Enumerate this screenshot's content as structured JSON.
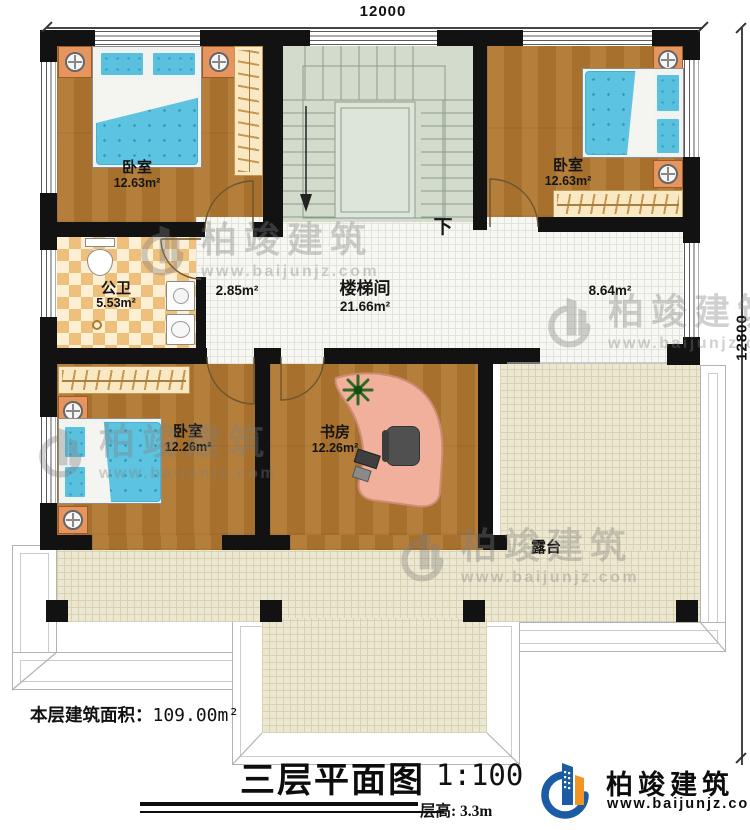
{
  "dimensions": {
    "width_mm": "12000",
    "height_mm": "12800"
  },
  "rooms": {
    "bedroom_tl": {
      "name": "卧室",
      "area": "12.63m²"
    },
    "bedroom_tr": {
      "name": "卧室",
      "area": "12.63m²"
    },
    "bathroom": {
      "name": "公卫",
      "area": "5.53m²"
    },
    "stairwell": {
      "name": "楼梯间",
      "area": "21.66m²"
    },
    "hall_left": {
      "area": "2.85m²"
    },
    "hall_right": {
      "area": "8.64m²"
    },
    "bedroom_bl": {
      "name": "卧室",
      "area": "12.26m²"
    },
    "study": {
      "name": "书房",
      "area": "12.26m²"
    },
    "terrace": {
      "name": "露台"
    },
    "stairs_down_label": "下"
  },
  "footer": {
    "floor_area_label": "本层建筑面积：",
    "floor_area_value": "109.00m²",
    "title": "三层平面图",
    "scale": "1:100",
    "floor_height": "层高: 3.3m"
  },
  "branding": {
    "company": "柏竣建筑",
    "website": "www.baijunjz.com"
  },
  "watermark": {
    "company": "柏竣建筑",
    "website": "www.baijunjz.com"
  },
  "colors": {
    "wall": "#121212",
    "wood_floor": "#b0762f",
    "bathroom_tile": "#eec07b",
    "stair": "#d2dbcc",
    "terrace_tile": "#ece7d0",
    "bed_blue": "#59c0de",
    "logo_blue": "#1c5ca5",
    "logo_orange": "#f29324"
  }
}
